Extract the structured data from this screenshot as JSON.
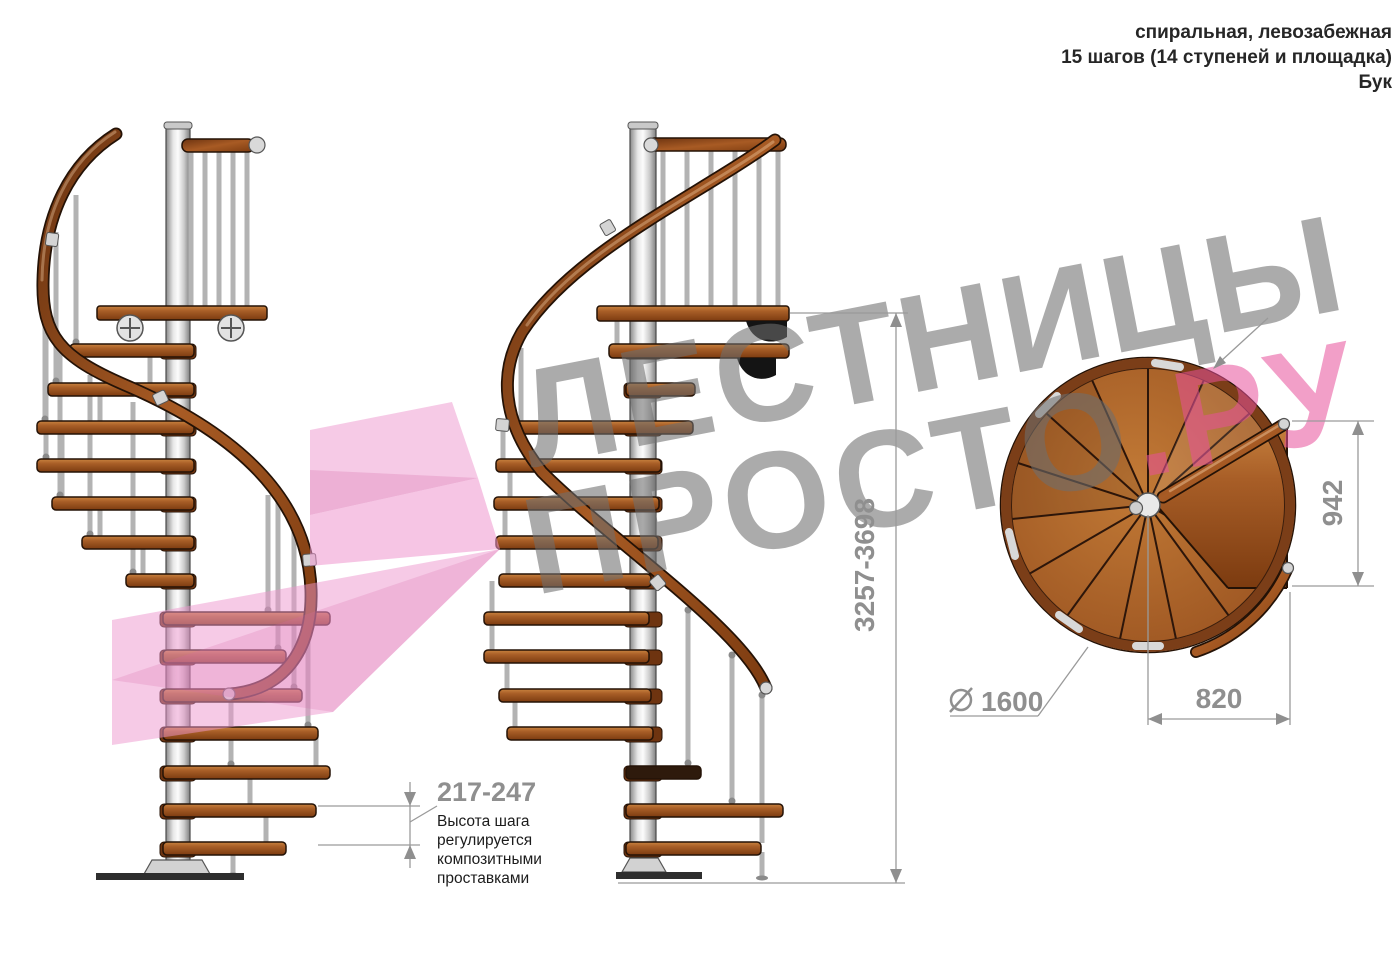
{
  "header": {
    "type_line": "спиральная, левозабежная",
    "steps_line": "15 шагов (14 ступеней и площадка)",
    "material_line": "Бук"
  },
  "watermark": {
    "line1": "ЛЕСТНИЦЫ",
    "line2_gray": "ПРОСТО",
    "line2_pink": ".РУ"
  },
  "dimensions": {
    "total_height": "3257-3698",
    "step_height": "217-247",
    "landing_width": "942",
    "landing_depth": "820",
    "diameter_value": "1600"
  },
  "annotation": {
    "line1": "Высота шага",
    "line2": "регулируется",
    "line3": "композитными",
    "line4": "проставками"
  },
  "colors": {
    "wood": "#a55a2a",
    "dim_gray": "#8f8f8f",
    "watermark_gray": "#a9a9a9",
    "watermark_pink": "#f2a6cf",
    "pole_silver": "#d9d9d9"
  }
}
